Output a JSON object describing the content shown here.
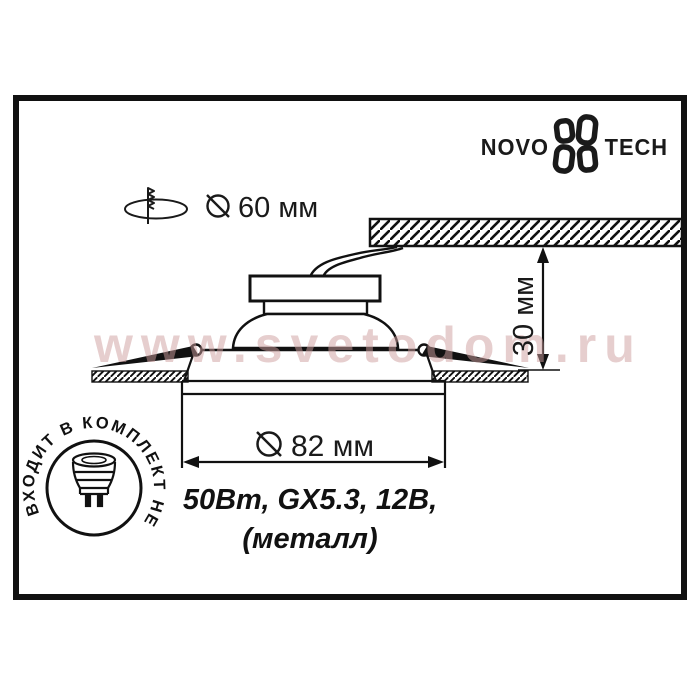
{
  "page": {
    "background": "#ffffff",
    "line_color": "#1a1a1a"
  },
  "frame": {
    "color": "#111111"
  },
  "logo": {
    "text_left": "NOVO",
    "text_right": "TECH"
  },
  "cutout_note": {
    "diameter_label": "60 мм"
  },
  "drawing": {
    "diameter_label": "82 мм",
    "depth_label": "30 мм"
  },
  "specs": {
    "line1": "50Вт, GX5.3, 12В,",
    "line2": "(металл)"
  },
  "lamp_badge": {
    "circular_text": "ВХОДИТ В КОМПЛЕКТ НЕ"
  },
  "watermark": {
    "text": "www.svetodom.ru",
    "color": "#cf9f9f"
  }
}
